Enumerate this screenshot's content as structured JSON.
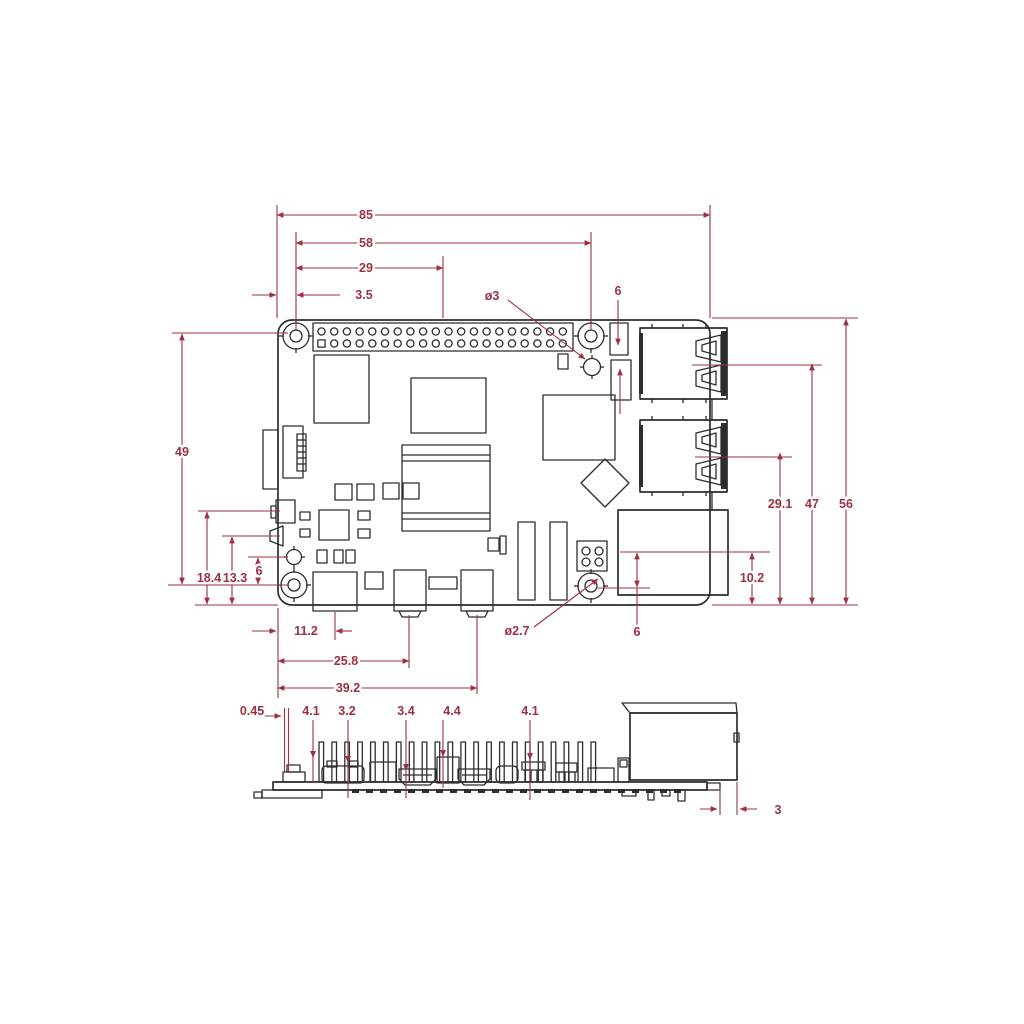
{
  "drawing": "raspberry-pi-board-mechanical-drawing",
  "colors": {
    "dimension": "#9d3043",
    "outline": "#2d2d2d",
    "background": "#ffffff"
  },
  "dimensions": {
    "top": {
      "overall_width": "85",
      "hole_spacing_x": "58",
      "hole_to_center": "29",
      "edge_to_hole": "3.5",
      "hole_diameter": "ø3",
      "usb_edge_offset": "6"
    },
    "left": {
      "hole_spacing_y": "49",
      "connector_offset_a": "18.4",
      "connector_offset_b": "13.3",
      "jack_to_hole": "6"
    },
    "right": {
      "usb2_center": "29.1",
      "usb1_center": "47",
      "overall_height": "56",
      "ethernet_center": "10.2"
    },
    "bottom": {
      "usbc_center": "11.2",
      "hdmi0_center": "25.8",
      "hdmi1_center": "39.2",
      "hole_diameter": "ø2.7",
      "ethernet_to_hole": "6"
    },
    "side": {
      "pcb_offset": "0.45",
      "height_a": "4.1",
      "usbc_height": "3.2",
      "hdmi_height": "3.4",
      "header_height": "4.4",
      "jack_height": "4.1",
      "ethernet_overhang": "3"
    }
  }
}
